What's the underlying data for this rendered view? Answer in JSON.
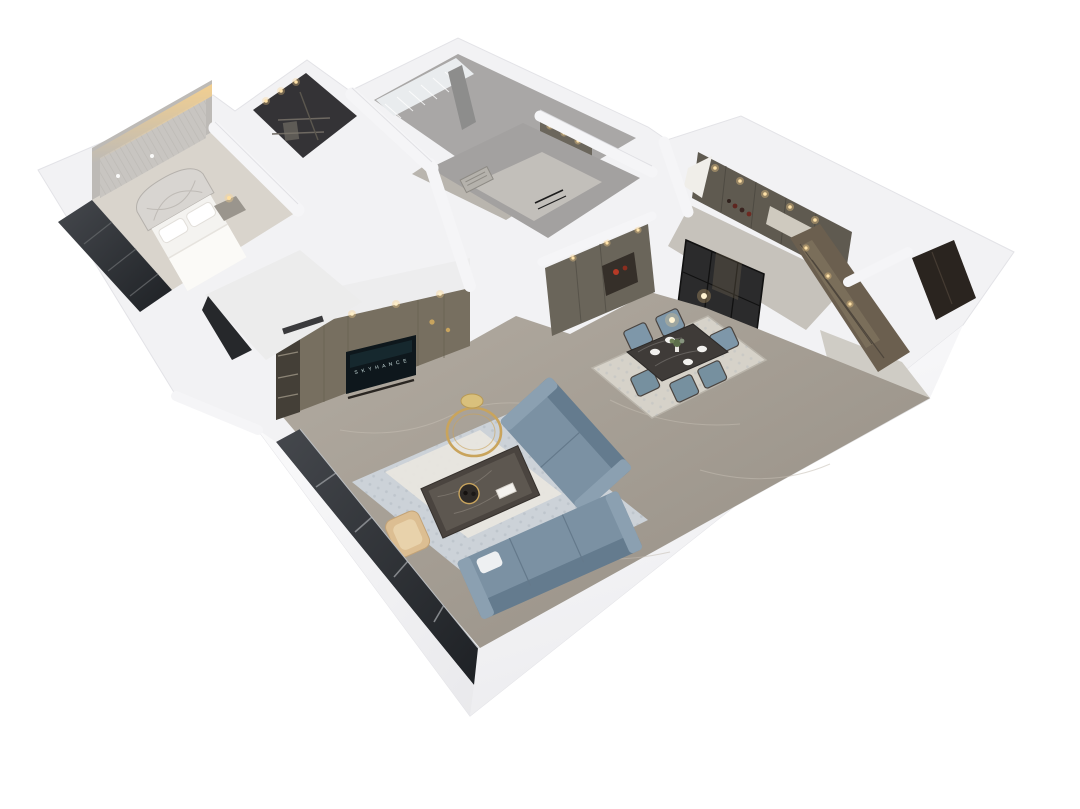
{
  "meta": {
    "type": "3d-floorplan-render",
    "style": "isometric cutaway dollhouse view of a modern apartment",
    "background": "#ffffff"
  },
  "tv": {
    "screen_text": "S K Y H A N C E"
  },
  "palette": {
    "wall_white": "#f3f3f5",
    "wall_face_light": "#fbfbfd",
    "floor_marble": "#a59f96",
    "floor_light": "#d9d4cc",
    "cabinet_olive": "#6f6a5e",
    "sofa_blue": "#7b91a3",
    "accent_gold": "#c9a45c",
    "warm_light": "#ffd489",
    "glass_dark": "#2b2e32",
    "rug_living": "#ccd2d8",
    "rug_dining": "#d6d2c9",
    "bronze_cabinet": "#6b5f4f",
    "tan_leather": "#dcbe92",
    "tv_screen": "#0e171c"
  },
  "rooms": [
    {
      "id": "master-bedroom",
      "features": [
        "bed-with-arched-tufted-headboard",
        "backlit-textured-accent-wall",
        "nightstand-with-lamp",
        "dark-glazed-window-wall"
      ]
    },
    {
      "id": "walk-in-closet",
      "features": [
        "dark-mirrored-wardrobe",
        "recessed-downlights"
      ]
    },
    {
      "id": "second-bedroom",
      "features": [
        "sheer-curtains",
        "grey-accent-wall",
        "warm-lit-wardrobe"
      ]
    },
    {
      "id": "bathroom-hall",
      "features": [
        "floor-drain",
        "black-glass-partition",
        "grey-walls"
      ]
    },
    {
      "id": "kitchen",
      "features": [
        "olive-cabinetry",
        "wine-shelf-with-bottles",
        "black-framed-glass-doors",
        "recessed-downlights"
      ]
    },
    {
      "id": "dining-area",
      "features": [
        "dark-marble-top-table",
        "six-blue-upholstered-chairs",
        "pendant-lights",
        "patterned-rug",
        "white-plates",
        "flower-centerpiece"
      ]
    },
    {
      "id": "living-room",
      "features": [
        "l-shaped-blue-sectional-sofa",
        "dark-marble-coffee-table",
        "gold-ring-decor",
        "gold-stool",
        "tan-accent-chair",
        "media-wall-with-tv",
        "patterned-blue-rug"
      ]
    },
    {
      "id": "entry-hall",
      "features": [
        "bronze-glass-display-cabinet",
        "dark-entry-door"
      ]
    },
    {
      "id": "balcony-window-wall",
      "features": [
        "full-height-grey-glazing-with-mullions"
      ]
    }
  ],
  "counts": {
    "dining_chairs": 6,
    "dining_plates": 4,
    "sofa_sections": 2,
    "pendant_bulbs": 2
  }
}
